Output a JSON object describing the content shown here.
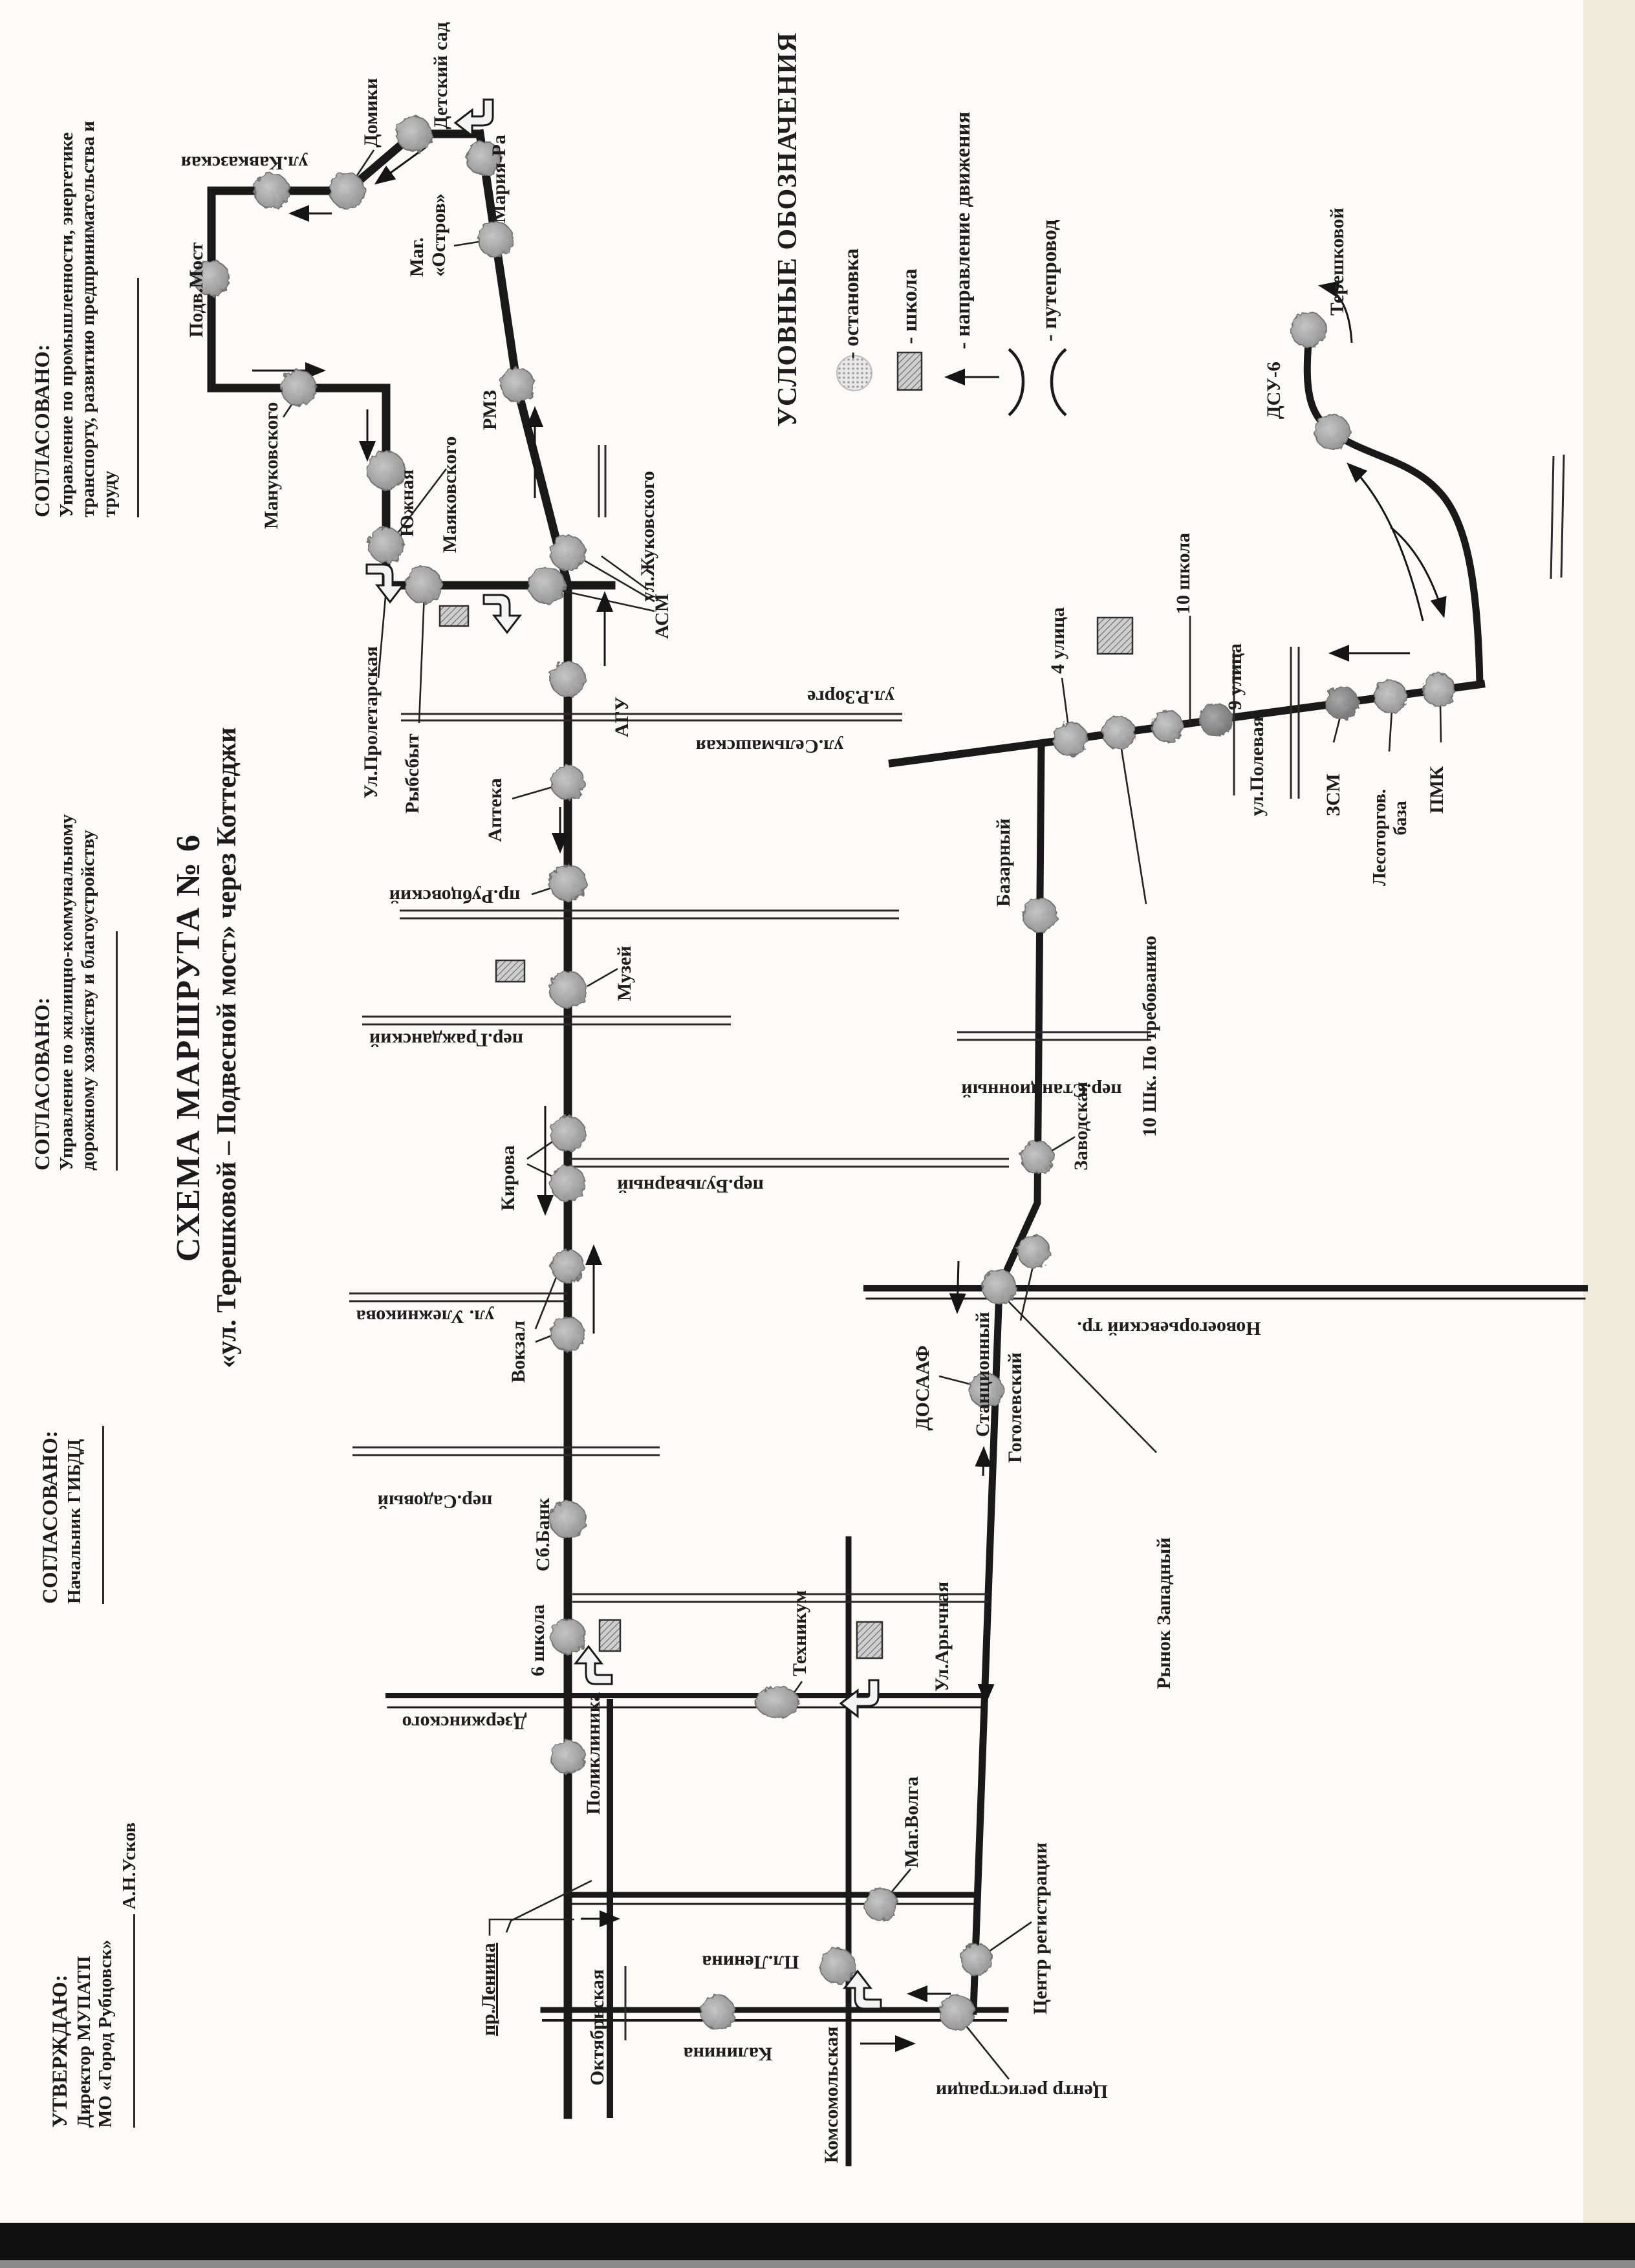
{
  "document": {
    "approvals": [
      {
        "title": "СОГЛАСОВАНО:",
        "line1": "Управление по промышленности, энергетике",
        "line2": "транспорту, развитию предпринимательства и труду"
      },
      {
        "title": "СОГЛАСОВАНО:",
        "line1": "Управление по жилищно-коммунальному",
        "line2": "дорожному хозяйству и благоустройству"
      },
      {
        "title": "СОГЛАСОВАНО:",
        "line1": "Начальник ГИБДД"
      },
      {
        "title": "УТВЕРЖДАЮ:",
        "line1": "Директор МУПАТП",
        "line2": "МО «Город Рубцовск»",
        "signer": "А.Н.Усков"
      }
    ],
    "title": {
      "line1": "СХЕМА  МАРШРУТА № 6",
      "line2": "«ул. Терешковой – Подвесной мост» через Коттеджи"
    }
  },
  "legend": {
    "title": "УСЛОВНЫЕ ОБОЗНАЧЕНИЯ",
    "stop": "- остановка",
    "school": "- школа",
    "direction": "- направление движения",
    "overpass": "- путепровод"
  },
  "map": {
    "labels": {
      "detsad": "Детский сад",
      "domiki": "Домики",
      "kavkazskaya": "ул.Кавказская",
      "podvmost": "Подв.Мост",
      "manukovskogo": "Мануковского",
      "yuzhnaya": "Южная",
      "mayakovskogo": "Маяковского",
      "mariara": "Мария-Ра",
      "magostrov1": "Маг.",
      "magostrov2": "«Остров»",
      "rmz": "РМЗ",
      "zhukovskogo": "ул.Жуковского",
      "asm": "АСМ",
      "agu": "АГУ",
      "proletarskaya": "Ул.Пролетарская",
      "rybsbyt": "Рыбсбыт",
      "apteka": "Аптека",
      "selmashskaya": "ул.Сельмашская",
      "rubcovskiy": "пр.Рубцовский",
      "muzey": "Музей",
      "grazhdanskiy": "пер.Гражданский",
      "kirova": "Кирова",
      "bulvarnyy": "пер.Бульварный",
      "ulezhnikova": "ул. Улежникова",
      "vokzal": "Вокзал",
      "sadovyy": "пер.Садовый",
      "sbbank": "Сб.Банк",
      "shkola6": "6 школа",
      "dzerzhinskogo": "Дзержинского",
      "poliklinika": "Поликлиника",
      "tehnikum": "Техникум",
      "prlenina": "пр.Ленина",
      "oktyabrskaya": "Октябрьская",
      "pllenina": "Пл.Ленина",
      "kalinina": "Калинина",
      "komsomolskaya": "Комсомольская",
      "magvolga": "Маг.Волга",
      "centrreg1": "Центр регистрации",
      "centrreg2": "Центр регистрации",
      "arychnaya": "Ул.Арычная",
      "dosaaf": "ДОСААФ",
      "novoegorievskiy": "Новоегорьевский тр.",
      "rynok": "Рынок Западный",
      "stancionnyy": "Станционный",
      "perstancionnyy": "пер.Станционный",
      "gogolevskiy": "Гоголевский",
      "zavodskaya": "Заводская",
      "bazarnyy": "Базарный",
      "zorge": "ул.Р.Зорге",
      "ul4": "4 улица",
      "shk10potreb": "10 Шк. По требованию",
      "shkola10": "10 школа",
      "ul9": "9 улица",
      "polevaya": "ул.Полевая",
      "zsm": "ЗСМ",
      "lesotorg1": "Лесоторгов.",
      "lesotorg2": "база",
      "pmk": "ПМК",
      "dsu6": "ДСУ-6",
      "tereshkovoy": "Терешковой"
    }
  }
}
